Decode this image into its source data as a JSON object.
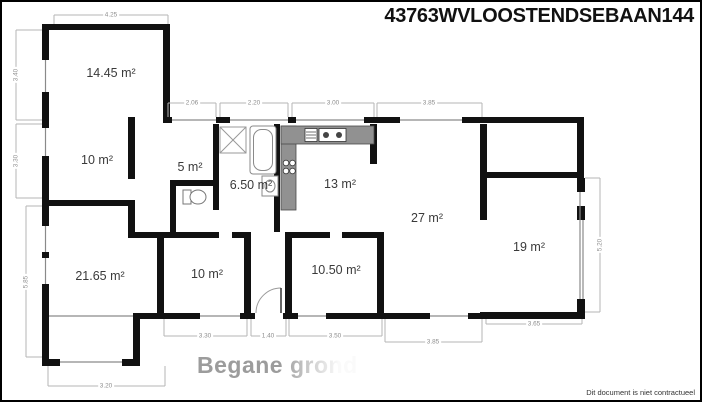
{
  "title": "43763WVLOOSTENDSEBAAN144",
  "floor": {
    "name": "Begane grond",
    "disclaimer": "Dit document is niet contractueel"
  },
  "rooms": [
    {
      "location": "top-left",
      "area": "14.45 m²"
    },
    {
      "location": "middle-left",
      "area": "10 m²"
    },
    {
      "location": "hallway",
      "area": "5 m²"
    },
    {
      "location": "bathroom",
      "area": "6.50 m²"
    },
    {
      "location": "kitchen",
      "area": "13 m²"
    },
    {
      "location": "living-room",
      "area": "27 m²"
    },
    {
      "location": "right",
      "area": "19 m²"
    },
    {
      "location": "bottom-left",
      "area": "21.65 m²"
    },
    {
      "location": "bottom-middle",
      "area": "10 m²"
    },
    {
      "location": "bottom-center",
      "area": "10.50 m²"
    }
  ],
  "dimensions_m": {
    "top": [
      "4.25",
      "2.06",
      "2.20",
      "3.00",
      "3.85"
    ],
    "left": [
      "3.40",
      "3.30",
      "5.85"
    ],
    "right": [
      "5.20"
    ],
    "bottom": [
      "3.20",
      "3.30",
      "1.40",
      "3.50",
      "3.85",
      "3.65"
    ]
  },
  "fixtures": [
    "shower",
    "bathtub",
    "washbasin",
    "toilet",
    "kitchen-counter",
    "stove",
    "kitchen-sink",
    "door-swing"
  ],
  "colors": {
    "wall": "#111111",
    "dimension_text": "#8d8d8d",
    "watermark": "#9c9c9c",
    "counter": "#919191"
  }
}
